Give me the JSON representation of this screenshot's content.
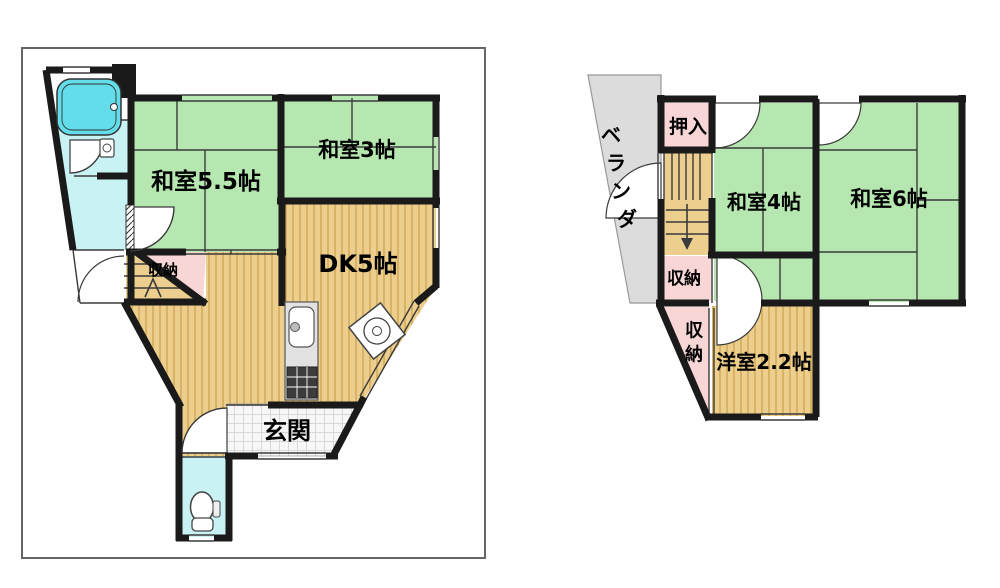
{
  "palette": {
    "wall": "#1a1a1a",
    "line": "#3a3a3a",
    "tatami-green": "#b7e7b1",
    "wood-tan": "#eccf8f",
    "wood-stripe": "#d9b264",
    "closet-pink": "#f8d6d6",
    "water-cyan": "#c9f2f4",
    "tub-cyan": "#63dde9",
    "veranda-gray": "#dcdcdc",
    "checker-bg": "#f7f7f7",
    "checker-line": "#d8d8d8",
    "fixture-gray": "#e2e2e2",
    "stove-dark": "#3c3c3c",
    "border-gray": "#666666"
  },
  "floor1": {
    "rooms": {
      "washitsu55": "和室5.5帖",
      "washitsu3": "和室3帖",
      "dk": "DK5帖",
      "storage": "収納",
      "genkan": "玄関"
    }
  },
  "floor2": {
    "rooms": {
      "oshiire": "押入",
      "washitsu4": "和室4帖",
      "washitsu6": "和室6帖",
      "storage_upper": "収納",
      "yoshitsu": "洋室2.2帖"
    },
    "storage_lower_chars": [
      "収",
      "納"
    ],
    "veranda_chars": [
      "ベ",
      "ラ",
      "ン",
      "ダ"
    ]
  }
}
